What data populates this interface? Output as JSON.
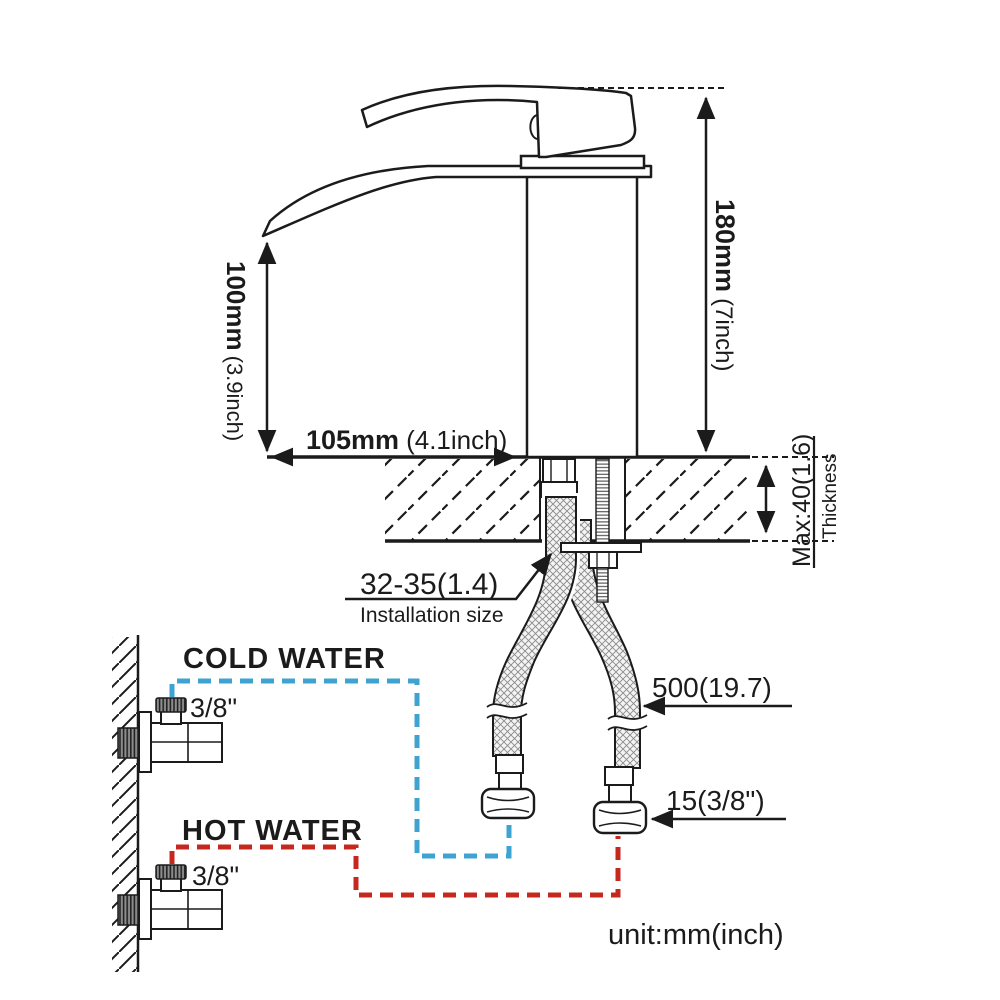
{
  "diagram": {
    "unit_note": "unit:mm(inch)",
    "dimensions": {
      "overall_height_mm": "180mm",
      "overall_height_inch": "(7inch)",
      "spout_height_mm": "100mm",
      "spout_height_inch": "(3.9inch)",
      "spout_reach_mm": "105mm",
      "spout_reach_inch": "(4.1inch)",
      "max_thickness": "Max:40(1.6)",
      "thickness_label": "Thickness",
      "installation_size": "32-35(1.4)",
      "installation_label": "Installation size",
      "hose_length": "500(19.7)",
      "hose_connector": "15(3/8\")"
    },
    "supply": {
      "cold_label": "COLD WATER",
      "cold_size": "3/8\"",
      "hot_label": "HOT WATER",
      "hot_size": "3/8\""
    },
    "colors": {
      "line": "#1b1b1b",
      "cold": "#3fa3d2",
      "hot": "#c4281e",
      "background": "#ffffff"
    }
  }
}
